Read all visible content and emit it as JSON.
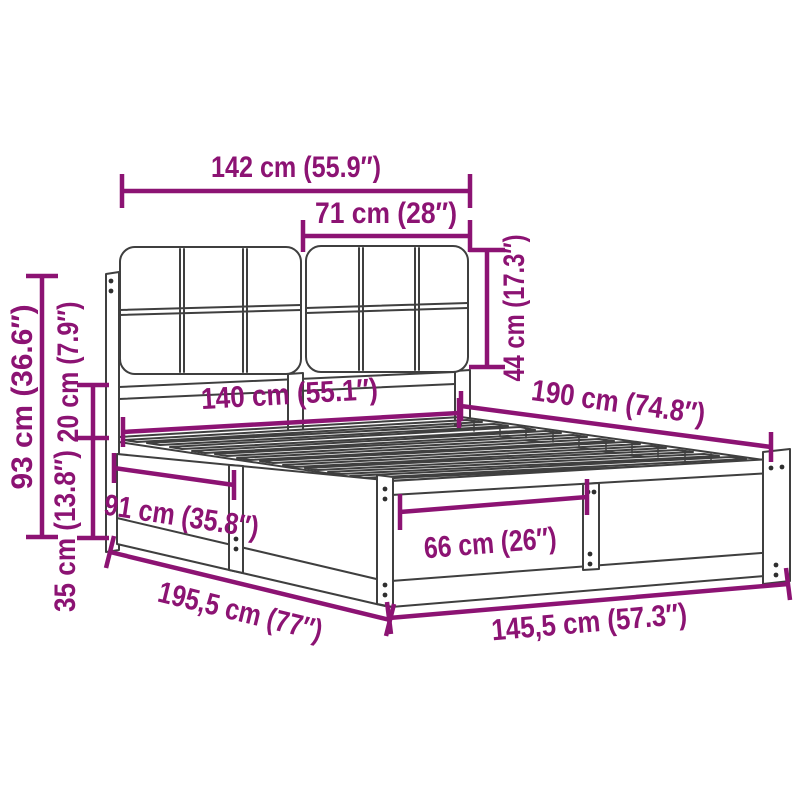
{
  "diagram": {
    "type": "product-dimension-diagram",
    "subject": "bed-frame-with-upholstered-headboard"
  },
  "colors": {
    "background": "#FFFFFF",
    "dimension_accent": "#8C1373",
    "line_art": "#3F3F3F"
  },
  "dimensions": [
    {
      "id": "headboard-total-width",
      "label": "142 cm (55.9″)",
      "cm": "142",
      "inch": "55.9"
    },
    {
      "id": "headboard-cushion-width",
      "label": "71 cm (28″)",
      "cm": "71",
      "inch": "28"
    },
    {
      "id": "headboard-cushion-height",
      "label": "44 cm (17.3″)",
      "cm": "44",
      "inch": "17.3"
    },
    {
      "id": "total-height",
      "label": "93 cm (36.6″)",
      "cm": "93",
      "inch": "36.6"
    },
    {
      "id": "cushion-to-frame-gap",
      "label": "20 cm (7.9″)",
      "cm": "20",
      "inch": "7.9"
    },
    {
      "id": "frame-side-height",
      "label": "35 cm (13.8″)",
      "cm": "35",
      "inch": "13.8"
    },
    {
      "id": "inner-width",
      "label": "140 cm (55.1″)",
      "cm": "140",
      "inch": "55.1"
    },
    {
      "id": "inner-length",
      "label": "190 cm (74.8″)",
      "cm": "190",
      "inch": "74.8"
    },
    {
      "id": "side-rail-section-length",
      "label": "91 cm (35.8″)",
      "cm": "91",
      "inch": "35.8"
    },
    {
      "id": "foot-rail-section-width",
      "label": "66 cm (26″)",
      "cm": "66",
      "inch": "26"
    },
    {
      "id": "total-length",
      "label": "195,5 cm (77″)",
      "cm": "195,5",
      "inch": "77"
    },
    {
      "id": "total-width",
      "label": "145,5 cm (57.3″)",
      "cm": "145,5",
      "inch": "57.3"
    }
  ]
}
